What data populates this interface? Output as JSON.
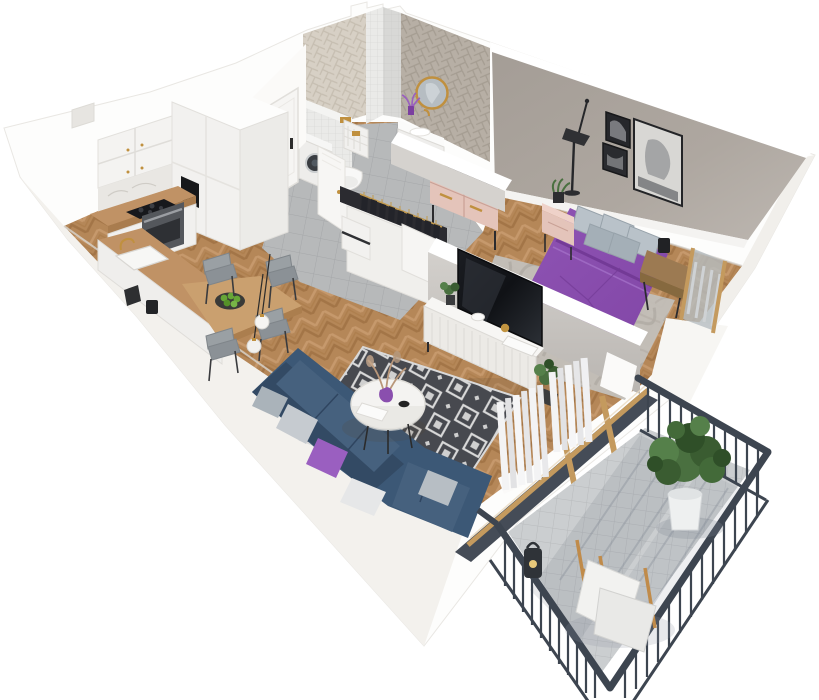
{
  "scene": {
    "title": "3D isometric floor plan render of a one-bedroom apartment with balcony",
    "background": "#ffffff",
    "rooms": [
      {
        "name": "kitchen-dining",
        "items": [
          "white upper cabinets with gold knobs",
          "tall white cabinet column with built-in black coffee machine",
          "black induction cooktop",
          "steel-front oven",
          "marble backsplash",
          "wood countertop peninsula",
          "white sink with gold faucet",
          "wood dining table",
          "plate with green apples",
          "four gray chairs",
          "two white globe pendant lamps"
        ]
      },
      {
        "name": "hallway",
        "items": [
          "white entrance door with black handle",
          "gray ceramic tile floor",
          "open white wardrobe with dark hanging clothes and gold rail",
          "white drawer unit"
        ]
      },
      {
        "name": "bathroom",
        "items": [
          "light herringbone tiled wall",
          "gray herringbone tiled wall",
          "white square-tile shaft column",
          "round gold-framed mirror",
          "white floating vanity with sink and gold faucet",
          "purple flowers",
          "wall-hung toilet on tiled box with gold flush plate",
          "washing machine",
          "white laundry basket with gold tag",
          "white bathroom door ajar"
        ]
      },
      {
        "name": "bedroom",
        "items": [
          "taupe gray feature wall",
          "three black-framed monochrome artworks",
          "black floor lamp",
          "double bed with purple duvet",
          "five gray pillows",
          "black metal bed frame",
          "marbled gray rug",
          "pink nightstand with potted plant",
          "wooden side table with black lamp",
          "pink dresser with gold handles and black frame",
          "wood-framed balcony window with gray blinds"
        ]
      },
      {
        "name": "living-room",
        "items": [
          "navy corner sofa",
          "gray and purple scatter pillows",
          "black and white diamond-pattern rug",
          "round white coffee table",
          "purple vase with dried flowers",
          "white fluted TV sideboard",
          "flat-screen TV",
          "gold cup and white books",
          "potted plant",
          "white pleated curtains",
          "wood-framed glass balcony door"
        ]
      },
      {
        "name": "balcony",
        "items": [
          "charcoal metal railing with vertical balusters",
          "light gray tile floor",
          "green plant in white round planter",
          "folding wooden chairs with white cushions",
          "black candle lantern"
        ]
      }
    ]
  },
  "palette": {
    "background": "#ffffff",
    "wall_white": "#fdfdfc",
    "wall_shade": "#f1efeb",
    "floor_wood": "#bd8d5d",
    "wood_dark": "#a97a4b",
    "wood_light": "#cfa173",
    "hall_tile": "#b7b9ba",
    "balcony_tile": "#cbced0",
    "bedroom_wall": "#aba49d",
    "partition_gray": "#c9c5c1",
    "bed_purple": "#8a4fae",
    "accent_purple": "#9a5fc0",
    "sofa_navy": "#3c5876",
    "sofa_navy_dark": "#334a64",
    "rug_charcoal": "#47494f",
    "rug_white": "#d9d9d9",
    "railing_charcoal": "#3d4550",
    "pink_furniture": "#e4c4ba",
    "gold": "#c0903f",
    "counter_wood": "#c09265",
    "plant_green": "#4a7040",
    "plant_green_dark": "#2f4f28",
    "curtain_white": "#f3f3f4",
    "tv_black": "#15171b",
    "oven_gray": "#54575c",
    "pillow_gray": "#b9c2c9",
    "mirror_glass": "#b6bdc2",
    "bath_tile_light": "#d7d0c5",
    "bath_tile_gray": "#b7afa5"
  }
}
